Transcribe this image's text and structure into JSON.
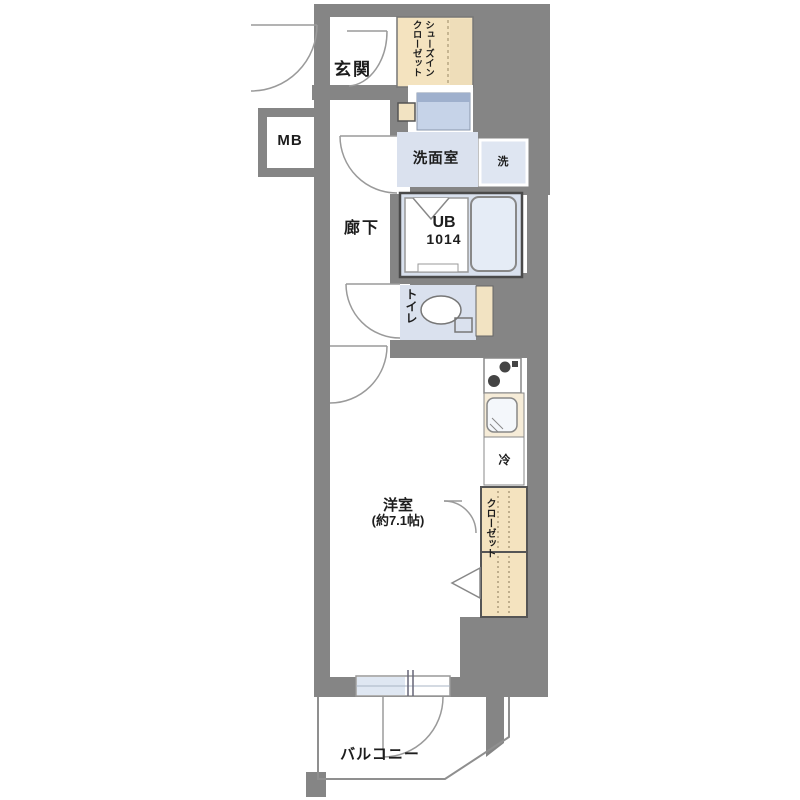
{
  "title": "apartment-floorplan",
  "labels": {
    "entrance": "玄関",
    "shoe_closet": "シューズイン\nクローゼット",
    "meter_box": "MB",
    "washroom": "洗面室",
    "washer": "洗",
    "unit_bath_line1": "UB",
    "unit_bath_line2": "1014",
    "hallway": "廊下",
    "toilet": "トイレ",
    "western_room_line1": "洋室",
    "western_room_line2": "(約7.1帖)",
    "closet": "クローゼット",
    "refrigerator": "冷",
    "balcony": "バルコニー"
  },
  "colors": {
    "wall_gray": "#858585",
    "room_blue": "#dae1ee",
    "fixture_blue": "#e5ecf6",
    "vanity_blue": "#c6d3e8",
    "closet_beige": "#f4e3bf",
    "door_line_gray": "#9a9a9a",
    "text": "#1d1d1d",
    "background": "#ffffff"
  }
}
